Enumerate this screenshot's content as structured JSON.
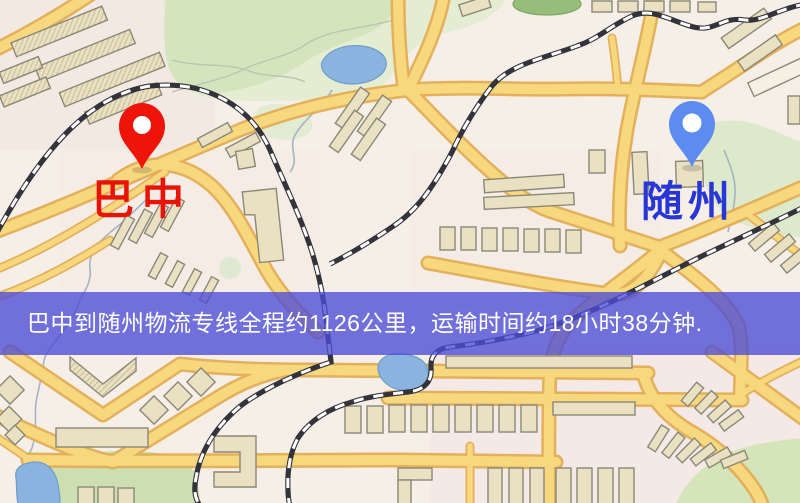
{
  "map": {
    "origin_label": "巴中",
    "destination_label": "随州",
    "banner_text": "巴中到随州物流专线全程约1126公里，运输时间约18小时38分钟."
  },
  "colors": {
    "origin_pin": "#ee1409",
    "origin_label": "#e81408",
    "destination_pin": "#5c8cf0",
    "destination_label": "#2836d6",
    "banner_bg": "#4c4cd6",
    "banner_text": "#ffffff",
    "road": "#f8d87f",
    "park": "#d4e4bd",
    "water": "#8ab4df"
  },
  "icons": {
    "origin_pin": "map-pin-icon",
    "destination_pin": "map-pin-icon"
  }
}
